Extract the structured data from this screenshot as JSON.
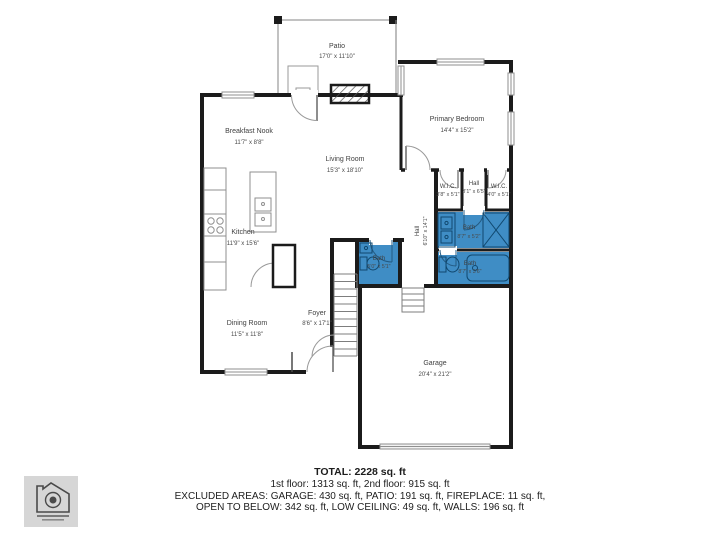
{
  "summary": {
    "total": "TOTAL: 2228 sq. ft",
    "floors": "1st floor: 1313 sq. ft, 2nd floor: 915 sq. ft",
    "excluded1": "EXCLUDED AREAS: GARAGE: 430 sq. ft, PATIO: 191 sq. ft, FIREPLACE: 11 sq. ft,",
    "excluded2": "OPEN TO BELOW: 342 sq. ft, LOW CEILING: 49 sq. ft, WALLS: 196 sq. ft"
  },
  "rooms": {
    "patio": {
      "name": "Patio",
      "dims": "17'0\" x 11'10\""
    },
    "breakfast_nook": {
      "name": "Breakfast Nook",
      "dims": "11'7\" x 8'8\""
    },
    "living_room": {
      "name": "Living Room",
      "dims": "15'3\" x 18'10\""
    },
    "primary_bedroom": {
      "name": "Primary Bedroom",
      "dims": "14'4\" x 15'2\""
    },
    "wic_left": {
      "name": "W.I.C.",
      "dims": "3'8\" x 5'1\""
    },
    "hall_upper": {
      "name": "Hall",
      "dims": "3'1\" x 6'5\""
    },
    "wic_right": {
      "name": "W.I.C.",
      "dims": "4'0\" x 5'1\""
    },
    "bath_primary": {
      "name": "Bath",
      "dims": "8'7\" x 5'2\""
    },
    "bath_lower": {
      "name": "Bath",
      "dims": "8'7\" x 3'6\""
    },
    "hall_main": {
      "name": "Hall",
      "dims": "6'10\" x 14'1\""
    },
    "kitchen": {
      "name": "Kitchen",
      "dims": "11'9\" x 15'6\""
    },
    "bath_small": {
      "name": "Bath",
      "dims": "5'0\" x 5'1\""
    },
    "foyer": {
      "name": "Foyer",
      "dims": "8'6\" x 17'1\""
    },
    "dining_room": {
      "name": "Dining Room",
      "dims": "11'5\" x 11'8\""
    },
    "garage": {
      "name": "Garage",
      "dims": "20'4\" x 21'2\""
    }
  },
  "colors": {
    "wall": "#1b1b1b",
    "bath_fill": "#3f8dc5",
    "fixture_stroke": "#10486f",
    "thin": "#8f8f8f"
  }
}
